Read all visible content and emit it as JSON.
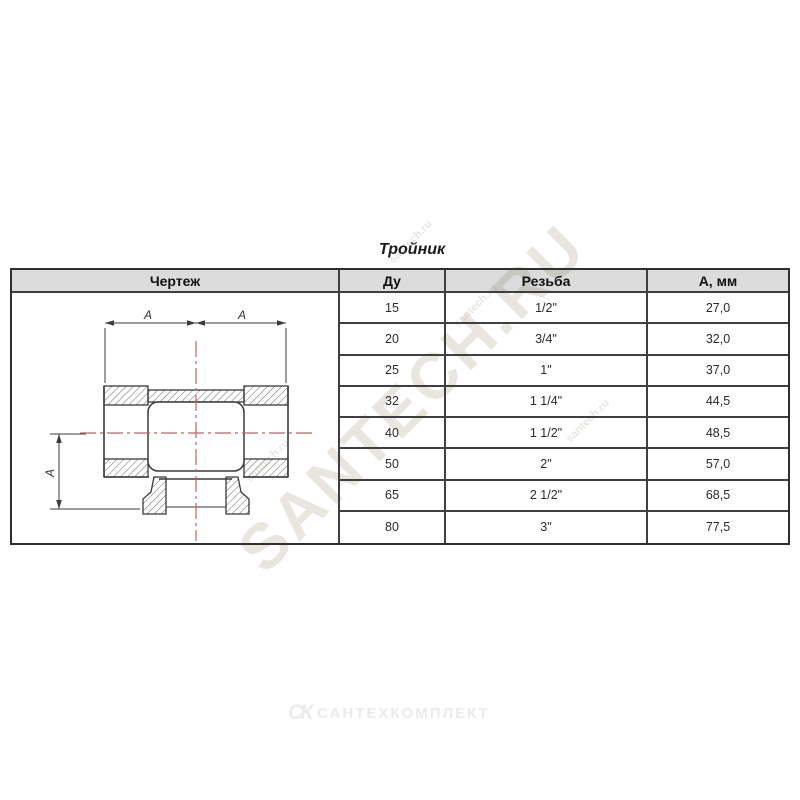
{
  "page": {
    "title": "Тройник"
  },
  "table": {
    "headers": {
      "drawing": "Чертеж",
      "dn": "Ду",
      "thread": "Резьба",
      "a_mm": "А, мм"
    },
    "rows": [
      {
        "dn": "15",
        "thread": "1/2\"",
        "a": "27,0"
      },
      {
        "dn": "20",
        "thread": "3/4\"",
        "a": "32,0"
      },
      {
        "dn": "25",
        "thread": "1\"",
        "a": "37,0"
      },
      {
        "dn": "32",
        "thread": "1 1/4\"",
        "a": "44,5"
      },
      {
        "dn": "40",
        "thread": "1 1/2\"",
        "a": "48,5"
      },
      {
        "dn": "50",
        "thread": "2\"",
        "a": "57,0"
      },
      {
        "dn": "65",
        "thread": "2 1/2\"",
        "a": "68,5"
      },
      {
        "dn": "80",
        "thread": "3\"",
        "a": "77,5"
      }
    ]
  },
  "drawing": {
    "dim_label": "A"
  },
  "watermarks": {
    "diagonal": "SANTECH.RU",
    "small": "santech.ru",
    "footer_logo": "СК",
    "footer_text": "САНТЕХКОМПЛЕКТ"
  },
  "colors": {
    "grid_line": "#3f3f3f",
    "header_bg": "#d9d9d9",
    "centerline_red": "#c86060",
    "watermark": "#d8d2c6"
  }
}
